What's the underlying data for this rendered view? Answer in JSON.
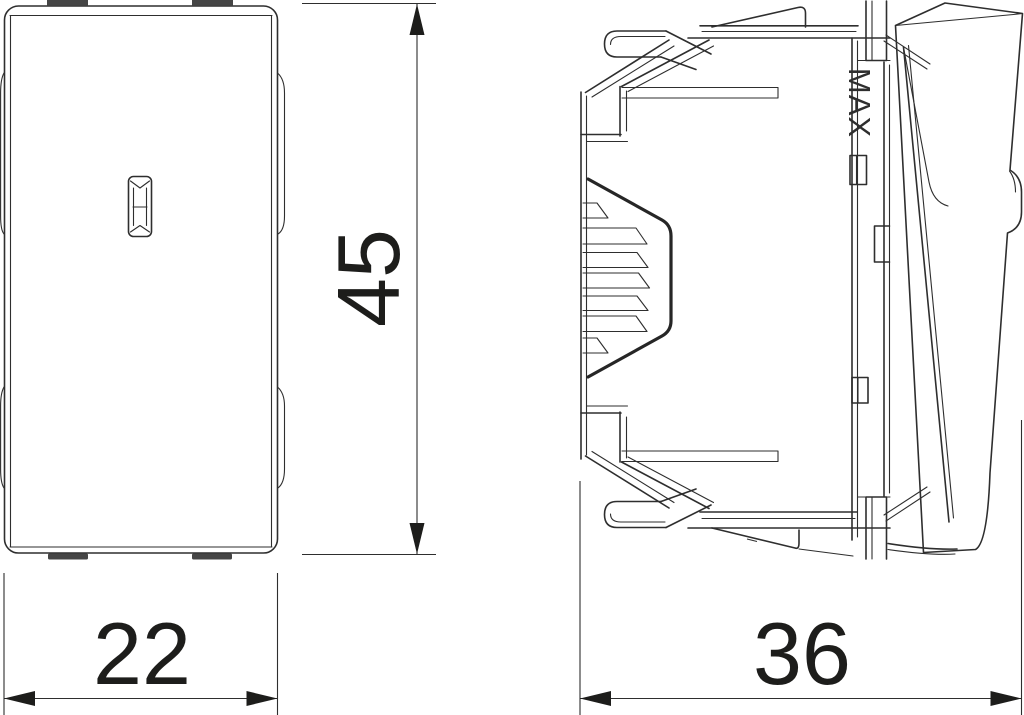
{
  "drawing": {
    "type": "technical-dimension-drawing",
    "views": {
      "front_view": "rocker switch front face with indicator lens and mounting tabs",
      "side_view": "rocker switch side profile with mounting claws, vent slots and rocker"
    },
    "dimensions": {
      "front_width": "22",
      "front_height": "45",
      "side_depth": "36"
    },
    "labels": {
      "max_marking": "MAX"
    },
    "colors": {
      "line": "#2e2e2e",
      "dimension_text": "#1d1d1b",
      "tab_fill": "#454545",
      "background": "#ffffff"
    }
  }
}
